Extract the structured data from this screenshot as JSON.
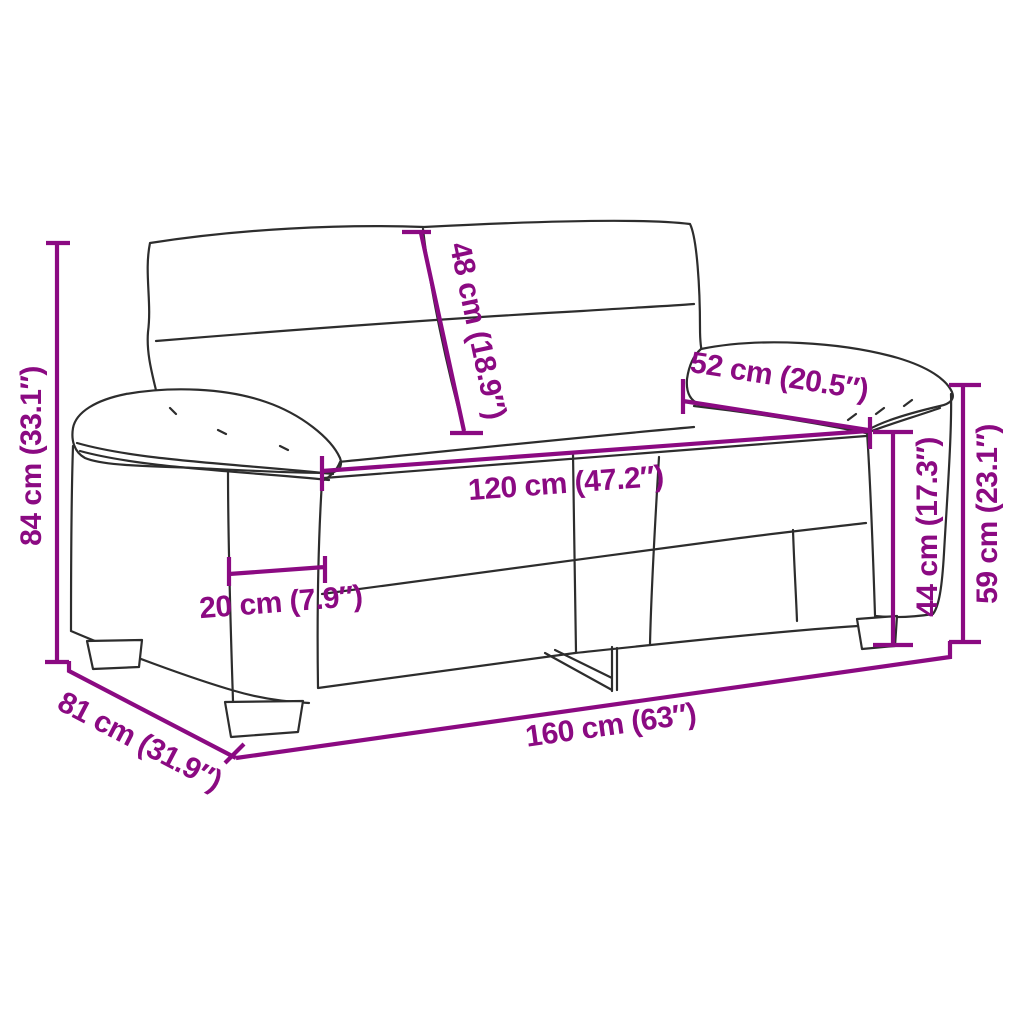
{
  "colors": {
    "dimension": "#8B0A82",
    "outline": "#2D2D2D",
    "background": "#FFFFFF"
  },
  "dimensions": {
    "overall_height": {
      "cm": "84",
      "inches": "33.1",
      "label": "84 cm (33.1″)"
    },
    "backrest_height": {
      "cm": "48",
      "inches": "18.9",
      "label": "48 cm (18.9″)"
    },
    "armrest_length": {
      "cm": "52",
      "inches": "20.5",
      "label": "52 cm (20.5″)"
    },
    "seat_width": {
      "cm": "120",
      "inches": "47.2",
      "label": "120 cm (47.2″)"
    },
    "armrest_width": {
      "cm": "20",
      "inches": "7.9",
      "label": "20 cm (7.9″)"
    },
    "seat_height": {
      "cm": "44",
      "inches": "17.3",
      "label": "44 cm (17.3″)"
    },
    "armrest_height": {
      "cm": "59",
      "inches": "23.1",
      "label": "59 cm (23.1″)"
    },
    "overall_depth": {
      "cm": "81",
      "inches": "31.9",
      "label": "81 cm (31.9″)"
    },
    "overall_width": {
      "cm": "160",
      "inches": "63",
      "label": "160 cm (63″)"
    }
  }
}
